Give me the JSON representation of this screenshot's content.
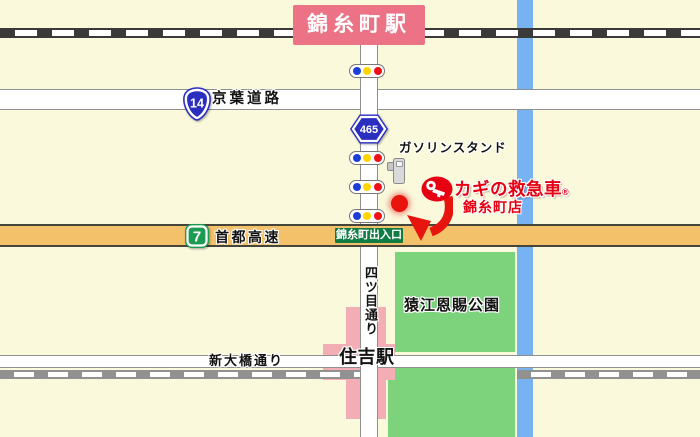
{
  "map_title": "カギの救急車 錦糸町店 周辺地図",
  "stations": {
    "kinshicho": {
      "name": "錦糸町駅"
    },
    "sumiyoshi": {
      "name": "住吉駅"
    }
  },
  "roads": {
    "keiyo": {
      "route_no": "14",
      "name": "京葉道路"
    },
    "shuto": {
      "route_no": "7",
      "name": "首都高速",
      "exit_label": "錦糸町出入口"
    },
    "yotsume": {
      "route_no": "465",
      "name": "四ツ目通り"
    },
    "shinohashi": {
      "name": "新大橋通り"
    }
  },
  "landmarks": {
    "gas_station": {
      "label": "ガソリンスタンド"
    },
    "park": {
      "name": "猿江恩賜公園"
    }
  },
  "store": {
    "brand": "カギの救急車",
    "registered_mark": "®",
    "branch": "錦糸町店"
  },
  "colors": {
    "background": "#FAF9DC",
    "river_blue": "#77B2F2",
    "park_green": "#7CD37C",
    "station_area_pink": "#F2ADB5",
    "station_sign_pink": "#EC7386",
    "expressway_orange": "#F3C169",
    "exit_sign_green": "#0F7C42",
    "route_shield_blue": "#2B2FC0",
    "expressway_shield_green": "#1E9B52",
    "brand_red": "#E60012",
    "marker_red": "#E8150E",
    "signal_blue": "#1C3ED8",
    "signal_yellow": "#FFD500",
    "signal_red": "#F01018"
  }
}
